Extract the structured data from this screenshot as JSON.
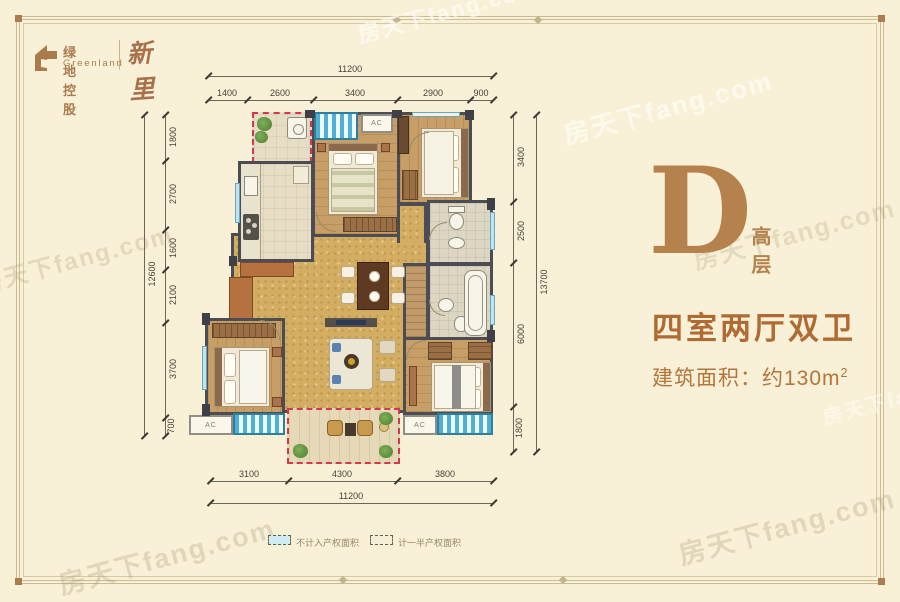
{
  "logo": {
    "company_cn": "绿地控股",
    "company_en": "Greenland",
    "brand_script": "新里"
  },
  "panel": {
    "unit_letter": "D",
    "unit_tag": "高层",
    "layout_title": "四室两厅双卫",
    "area_text": "建筑面积：约130m",
    "area_sup": "2"
  },
  "plan": {
    "ac_label": "AC"
  },
  "dimensions": {
    "top": {
      "total": "11200",
      "segments": [
        "1400",
        "2600",
        "3400",
        "2900",
        "900"
      ]
    },
    "bottom": {
      "total": "11200",
      "segments": [
        "3100",
        "4300",
        "3800"
      ]
    },
    "left": {
      "total": "12600",
      "segments": [
        "1800",
        "2700",
        "1600",
        "2100",
        "3700",
        "700"
      ]
    },
    "right": {
      "total": "13700",
      "segments": [
        "3400",
        "2500",
        "6000",
        "1800"
      ]
    }
  },
  "legend": {
    "items": [
      {
        "label": "不计入产权面积"
      },
      {
        "label": "计一半产权面积"
      }
    ]
  },
  "watermark": {
    "text": "房天下fang.com"
  },
  "colors": {
    "accent_bronze": "#b5814c",
    "accent_brown": "#b06a33",
    "wall": "#4c4c55",
    "bay_blue": "#4fb0d4",
    "dash_red": "#cf3a4e",
    "background": "#f9f1d7"
  }
}
